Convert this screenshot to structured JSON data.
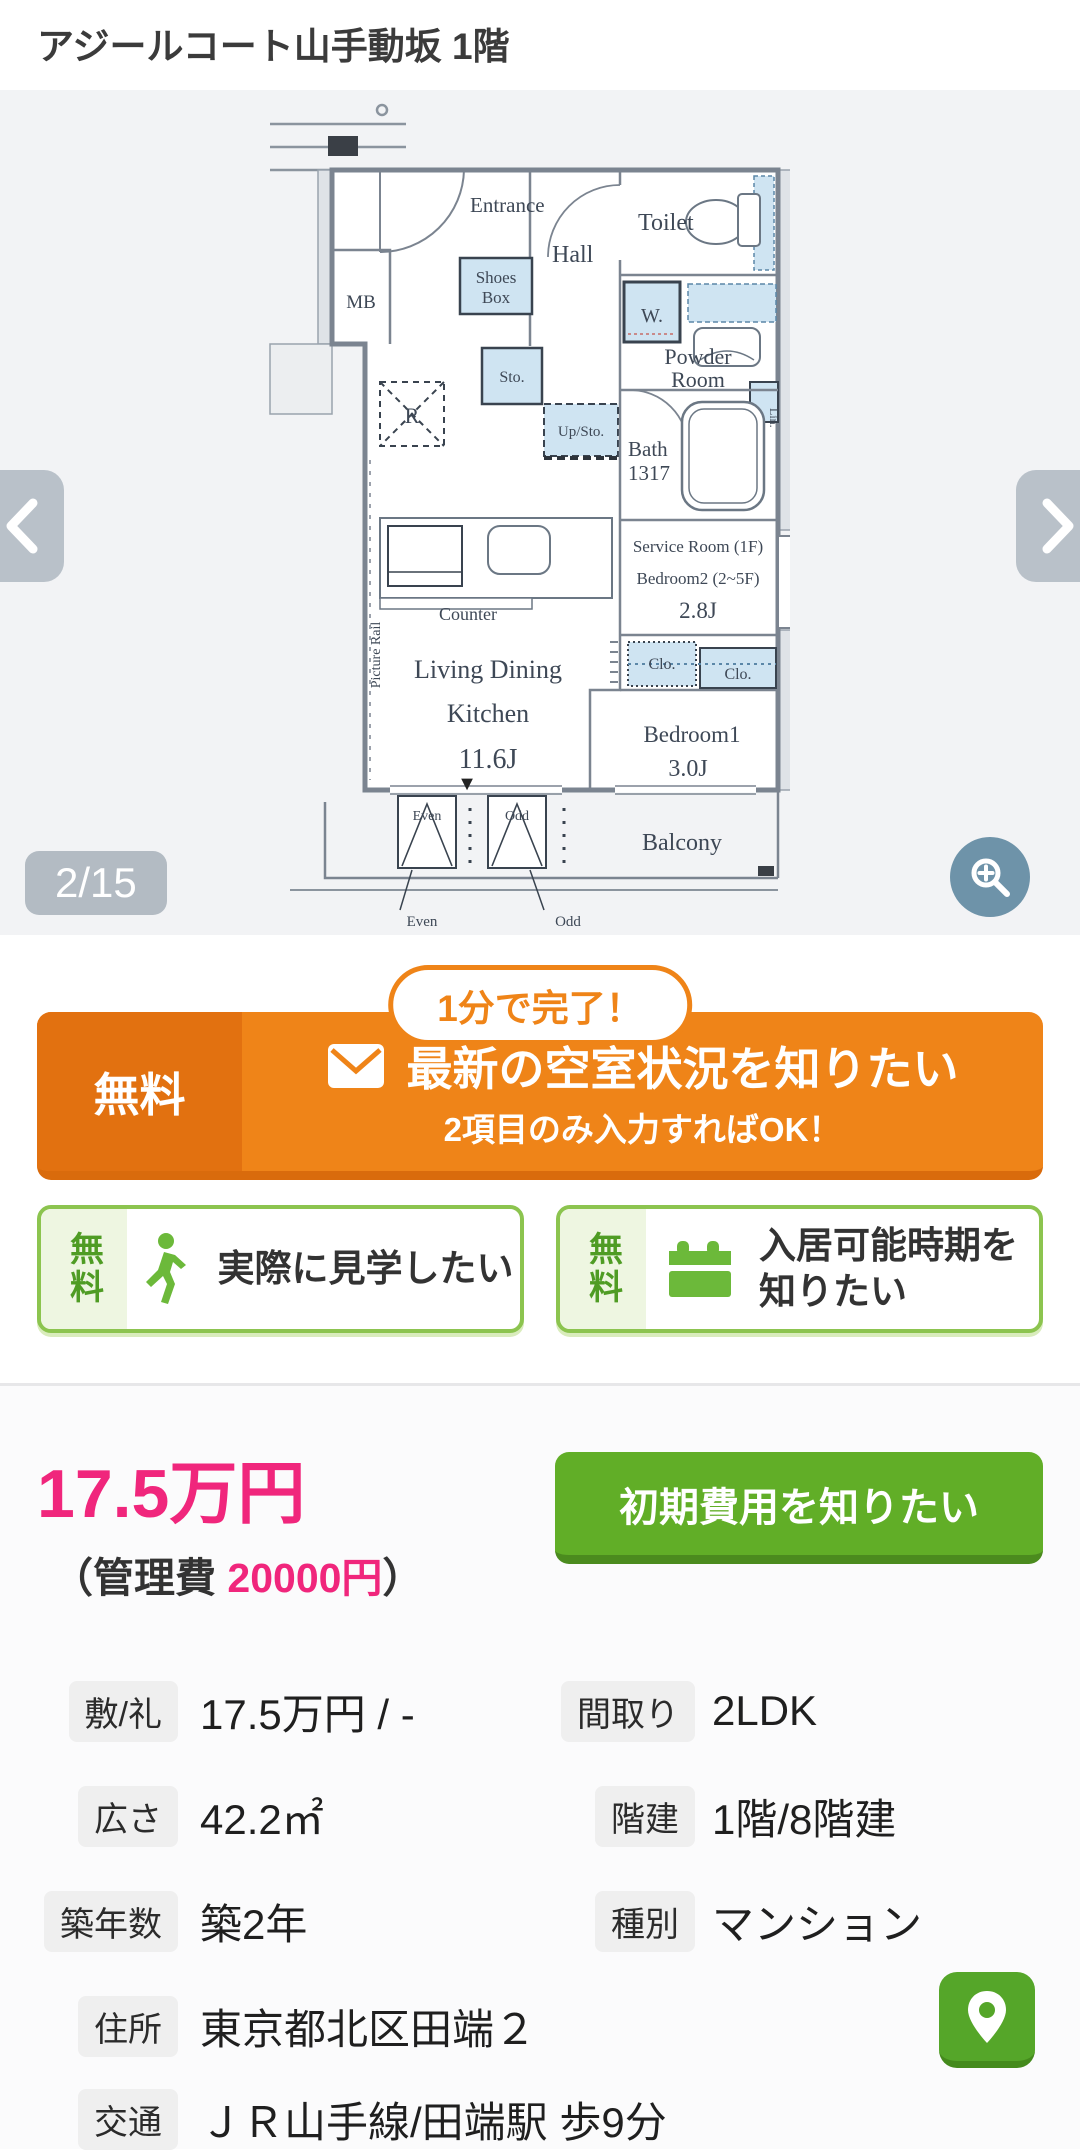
{
  "page": {
    "title": "アジールコート山手動坂 1階"
  },
  "carousel": {
    "counter": "2/15",
    "prev_icon": "chevron-left",
    "next_icon": "chevron-right",
    "zoom_icon": "magnifier-plus"
  },
  "floorplan": {
    "entrance": "Entrance",
    "hall": "Hall",
    "toilet": "Toilet",
    "shoes1": "Shoes",
    "shoes2": "Box",
    "mb": "MB",
    "w": "W.",
    "sto": "Sto.",
    "upsto": "Up/Sto.",
    "powder1": "Powder",
    "powder2": "Room",
    "lin": "Lin.",
    "r": "R",
    "bath1": "Bath",
    "bath2": "1317",
    "counter": "Counter",
    "living1": "Living Dining",
    "living2": "Kitchen",
    "living_size": "11.6J",
    "picture_rail": "Picture Rail",
    "service_room": "Service Room (1F)",
    "bedroom2": "Bedroom2 (2~5F)",
    "bedroom2_size": "2.8J",
    "clo1": "Clo.",
    "clo2": "Clo.",
    "bedroom1": "Bedroom1",
    "bedroom1_size": "3.0J",
    "balcony": "Balcony",
    "even_box": "Even",
    "odd_box": "Odd",
    "even_note": "Even",
    "odd_note": "Odd",
    "marker": "▼"
  },
  "cta_banner": {
    "badge": "1分で完了！",
    "free_label": "無料",
    "title": "最新の空室状況を知りたい",
    "subtitle": "2項目のみ入力すればOK！",
    "mail_icon": "envelope"
  },
  "action_buttons": {
    "visit": {
      "free_label": "無料",
      "label": "実際に見学したい",
      "icon": "walking-person"
    },
    "movein": {
      "free_label": "無料",
      "label_line1": "入居可能時期を",
      "label_line2": "知りたい",
      "icon": "calendar"
    }
  },
  "price": {
    "rent": "17.5万円",
    "management_prefix": "（管理費 ",
    "management_fee": "20000円",
    "management_suffix": "）",
    "init_cost_button": "初期費用を知りたい"
  },
  "details": {
    "rows": [
      {
        "cells": [
          {
            "label": "敷/礼",
            "value": "17.5万円 / -"
          },
          {
            "label": "間取り",
            "value": "2LDK"
          }
        ]
      },
      {
        "cells": [
          {
            "label": "広さ",
            "value": "42.2㎡"
          },
          {
            "label": "階建",
            "value": "1階/8階建"
          }
        ]
      },
      {
        "cells": [
          {
            "label": "築年数",
            "value": "築2年"
          },
          {
            "label": "種別",
            "value": "マンション"
          }
        ]
      }
    ],
    "address": {
      "label": "住所",
      "value": "東京都北区田端２"
    },
    "transport": {
      "label": "交通",
      "value": "ＪＲ山手線/田端駅 歩9分"
    },
    "map_icon": "map-pin"
  },
  "colors": {
    "accent_orange": "#ef8418",
    "accent_orange_dark": "#d96b0c",
    "accent_green": "#61ae27",
    "accent_green_border": "#8cc44f",
    "price_pink": "#f0267c",
    "carousel_bg": "#f2f3f5",
    "nav_gray": "#b9c1c9",
    "zoom_blue": "#6e93a9"
  }
}
